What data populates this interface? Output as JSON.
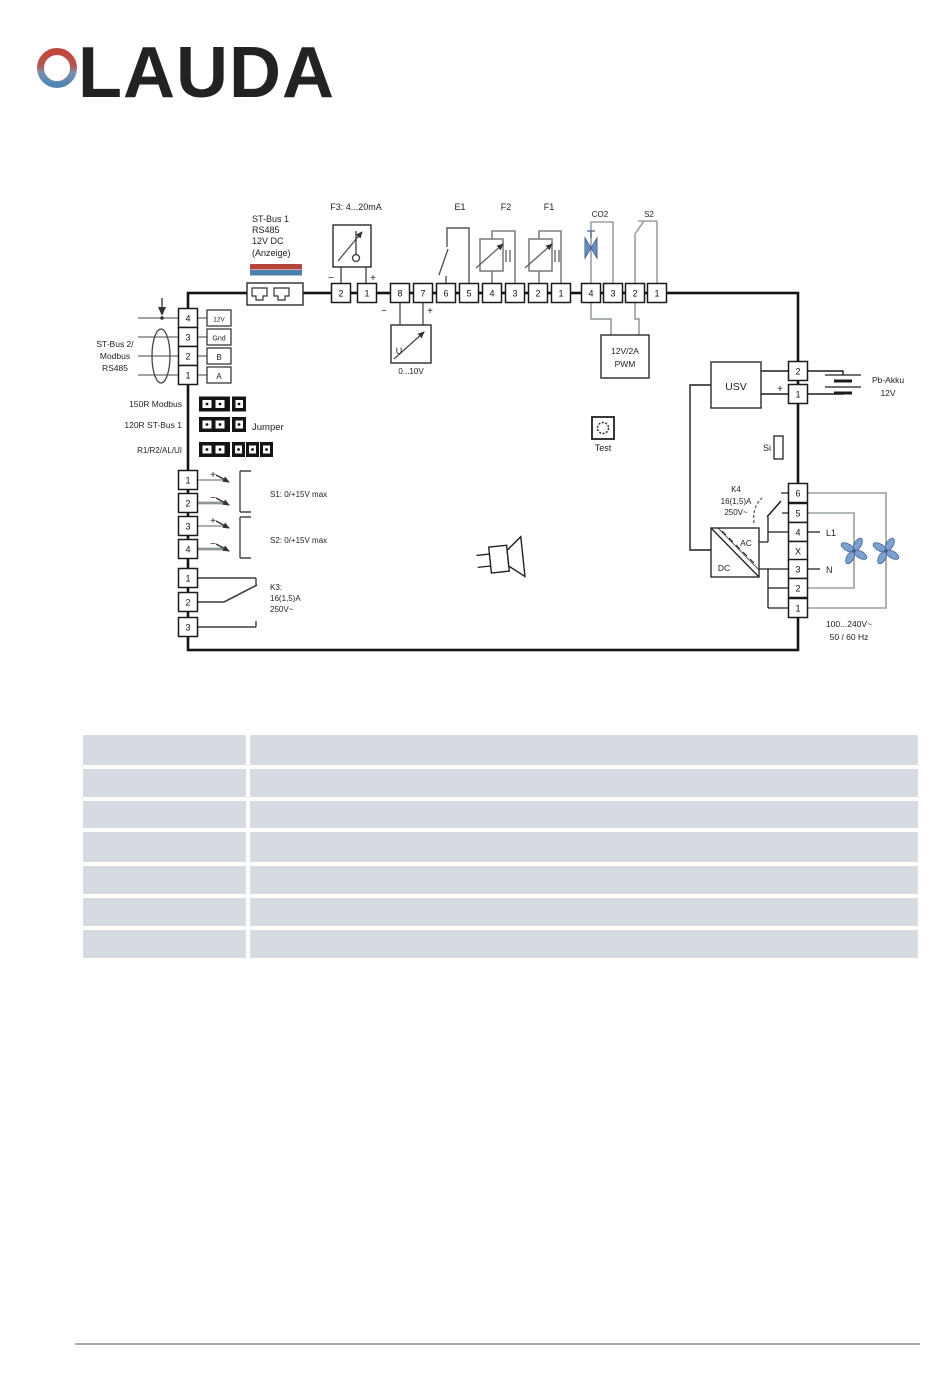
{
  "logo": {
    "brand": "LAUDA",
    "text_color": "#8b9196",
    "ring_top_color": "#c3473b",
    "ring_bottom_color": "#4e86b4"
  },
  "diagram": {
    "st_bus1": {
      "lines": [
        "ST-Bus 1",
        "RS485",
        "12V DC",
        "(Anzeige)"
      ]
    },
    "f3": {
      "label": "F3: 4...20mA",
      "minus": "−",
      "plus": "+"
    },
    "e1": {
      "label": "E1"
    },
    "f2": {
      "label": "F2"
    },
    "f1": {
      "label": "F1"
    },
    "co2": {
      "label": "CO2"
    },
    "s2_top": {
      "label": "S2"
    },
    "u_converter": {
      "symbol": "U",
      "minus": "−",
      "plus": "+",
      "range": "0...10V"
    },
    "pwm": {
      "lines": [
        "12V/2A",
        "PWM"
      ]
    },
    "usv": {
      "label": "USV"
    },
    "battery": {
      "plus": "+",
      "lines": [
        "Pb-Akku",
        "12V"
      ]
    },
    "si": {
      "label": "Si"
    },
    "test": {
      "label": "Test"
    },
    "k4": {
      "lines": [
        "K4",
        "16(1,5)A",
        "250V~"
      ]
    },
    "acdc": {
      "ac": "AC",
      "dc": "DC"
    },
    "mains": {
      "l1": "L1",
      "n": "N",
      "lines": [
        "100...240V~",
        "50 / 60 Hz"
      ]
    },
    "st_bus2": {
      "lines": [
        "ST-Bus 2/",
        "Modbus",
        "RS485"
      ],
      "pin_labels": [
        "12V",
        "Gnd",
        "B",
        "A"
      ]
    },
    "jumpers": {
      "rows": [
        "150R Modbus",
        "120R ST-Bus 1",
        "R1/R2/AL/UI"
      ],
      "label": "Jumper"
    },
    "s1_input": {
      "plus": "+",
      "minus": "−",
      "label": "S1: 0/+15V max"
    },
    "s2_input": {
      "plus": "+",
      "minus": "−",
      "label": "S2: 0/+15V max"
    },
    "k3": {
      "lines": [
        "K3:",
        "16(1,5)A",
        "250V~"
      ]
    },
    "terminals": {
      "top_f3": [
        "2",
        "1"
      ],
      "top_main": [
        "8",
        "7",
        "6",
        "5",
        "4",
        "3",
        "2",
        "1"
      ],
      "top_aux": [
        "4",
        "3",
        "2",
        "1"
      ],
      "right_battery": [
        "2",
        "1"
      ],
      "right_power": [
        "6",
        "5",
        "4",
        "X",
        "3",
        "2",
        "1"
      ],
      "left_rs485": [
        "4",
        "3",
        "2",
        "1"
      ],
      "left_inputs": [
        "1",
        "2",
        "3",
        "4"
      ],
      "left_k3": [
        "1",
        "2",
        "3"
      ]
    },
    "colors": {
      "wire_gray": "#8f9699",
      "accent_red": "#b5443a",
      "accent_blue": "#4a7fae",
      "fan_blue": "#7da0cc",
      "table_cell": "#d6dbe1"
    }
  },
  "table": {
    "rows": 7,
    "columns": 2,
    "content": "empty"
  }
}
